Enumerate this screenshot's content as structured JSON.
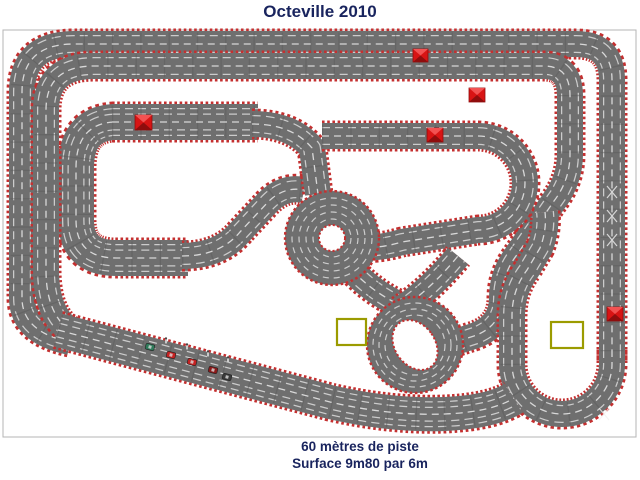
{
  "title": "Octeville 2010",
  "footer": {
    "line1": "60 mètres de piste",
    "line2": "Surface 9m80 par 6m"
  },
  "colors": {
    "text": "#19245e",
    "background": "#ffffff",
    "frame": "#b5b5b5",
    "track": "#6f6f6f",
    "curb": "#c43030",
    "lane": "#ebebeb",
    "seam": "#5c5c5c",
    "marker_red": "#d81414",
    "marker_red_light": "#f25252",
    "marker_red_dark": "#8f0d0d",
    "marker_yellow": "#9b9b00"
  },
  "markers": {
    "red_squares": [
      {
        "x": 135,
        "y": 115,
        "w": 17,
        "h": 15
      },
      {
        "x": 413,
        "y": 49,
        "w": 15,
        "h": 13
      },
      {
        "x": 469,
        "y": 88,
        "w": 16,
        "h": 14
      },
      {
        "x": 427,
        "y": 128,
        "w": 16,
        "h": 14
      },
      {
        "x": 607,
        "y": 307,
        "w": 16,
        "h": 14
      }
    ],
    "yellow_squares": [
      {
        "x": 337,
        "y": 319,
        "w": 29,
        "h": 26
      },
      {
        "x": 551,
        "y": 322,
        "w": 32,
        "h": 26
      }
    ],
    "lane_change_marks": [
      {
        "x": 612,
        "y": 192
      },
      {
        "x": 612,
        "y": 216
      },
      {
        "x": 612,
        "y": 240
      },
      {
        "x": 604,
        "y": 414
      }
    ]
  },
  "grid": {
    "cars": [
      {
        "x": 150,
        "y": 347,
        "color": "#2f7a5a"
      },
      {
        "x": 171,
        "y": 355,
        "color": "#c62222"
      },
      {
        "x": 192,
        "y": 362,
        "color": "#c62222"
      },
      {
        "x": 213,
        "y": 370,
        "color": "#8b1a1a"
      },
      {
        "x": 227,
        "y": 377,
        "color": "#3a3a3a"
      }
    ],
    "marshals": [
      {
        "x": 166,
        "y": 339
      },
      {
        "x": 187,
        "y": 345
      },
      {
        "x": 208,
        "y": 352
      },
      {
        "x": 228,
        "y": 358
      }
    ]
  }
}
